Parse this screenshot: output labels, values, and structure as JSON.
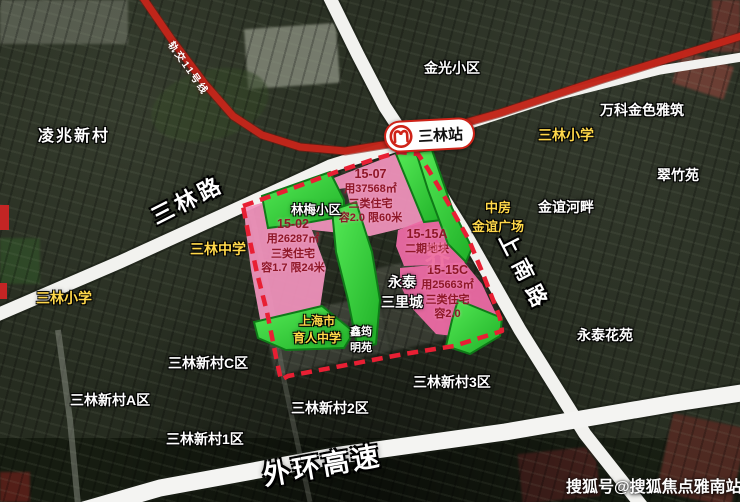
{
  "colors": {
    "parcel_pink_light": "#f293bd",
    "parcel_pink_deep": "#ec6aa4",
    "parcel_green": "#35dd3c",
    "boundary_red": "#e81f33",
    "metro_red": "#c4261a",
    "label_yellow": "#ffd84a",
    "road_white": "#f2f2ef",
    "parcel_text_red": "#8f1728"
  },
  "metro": {
    "station_name": "三林站",
    "line_name": "轨交11号线"
  },
  "roads": {
    "sanlin": "三林路",
    "shangnan": "上南路",
    "outer_ring": "外环高速"
  },
  "parcels": [
    {
      "id": "15-07",
      "area": "用37568㎡",
      "type": "三类住宅",
      "far": "容2.0 限60米"
    },
    {
      "id": "15-02",
      "area": "用26287㎡",
      "type": "三类住宅",
      "far": "容1.7 限24米"
    },
    {
      "id": "15-15A",
      "note": "二期地块"
    },
    {
      "id": "15-15C",
      "area": "用25663㎡",
      "type": "三类住宅",
      "far": "容2.0"
    }
  ],
  "places": {
    "lingzhao": "凌兆新村",
    "jinguang": "金光小区",
    "vanke": "万科金色雅筑",
    "cuizhu": "翠竹苑",
    "jinyi_hepan": "金谊河畔",
    "linmei": "林梅小区",
    "yongtai_sanli": "永泰\n三里城",
    "xinyun": "鑫筠\n明苑",
    "c_qu": "三林新村C区",
    "a_qu": "三林新村A区",
    "qu2": "三林新村2区",
    "qu3": "三林新村3区",
    "qu1": "三林新村1区",
    "yongtai_huayuan": "永泰花苑"
  },
  "schools": {
    "sanlin_xiaoxue_left": "三林小学",
    "sanlin_zhongxue": "三林中学",
    "sanlin_xiaoxue_right": "三林小学",
    "zhongfang": "中房\n金谊广场",
    "yuren": "上海市\n育人中学"
  },
  "watermarks": {
    "sohu": "搜狐号@搜狐焦点雅南站",
    "faint": "界"
  }
}
